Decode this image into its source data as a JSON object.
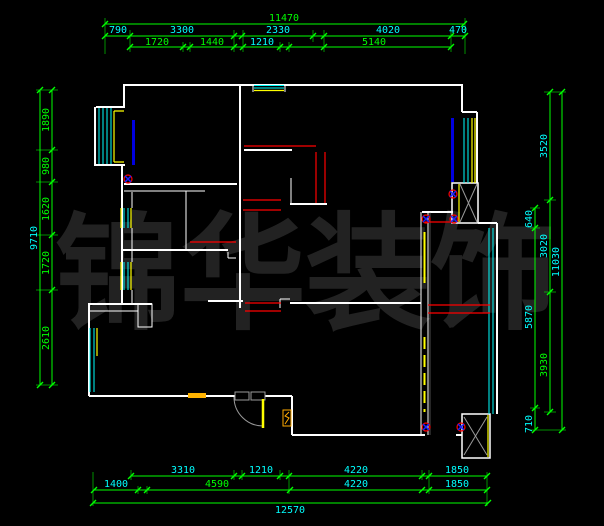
{
  "watermark": {
    "text": "锦华装饰",
    "chars": [
      "锦",
      "华",
      "装",
      "饰"
    ]
  },
  "colors": {
    "background": "#000000",
    "wall": "#ffffff",
    "dimension_line": "#00ff00",
    "dimension_text_cyan": "#00ffff",
    "dimension_text_green": "#00ff00",
    "window": "#00ffff",
    "beam": "#ff0000",
    "door_leaf": "#ffff00",
    "balcony_door_blue": "#0000e0"
  },
  "dimensions": {
    "top": {
      "total": "11470",
      "row2": [
        "790",
        "3300",
        "2330",
        "4020",
        "470"
      ],
      "row3": [
        "1720",
        "1440",
        "1210",
        "5140"
      ]
    },
    "left": {
      "total": "9710",
      "segments": [
        "1890",
        "980",
        "1620",
        "1720",
        "2610"
      ]
    },
    "right": {
      "total": "11030",
      "outer_segments": [
        "3520",
        "3020",
        "3930"
      ],
      "inner_segments": [
        "640",
        "5870",
        "710"
      ]
    },
    "bottom": {
      "total": "12570",
      "row1": [
        "3310",
        "1210",
        "4220",
        "1850"
      ],
      "row2": [
        "1400",
        "4590",
        "4220",
        "1850"
      ]
    }
  }
}
